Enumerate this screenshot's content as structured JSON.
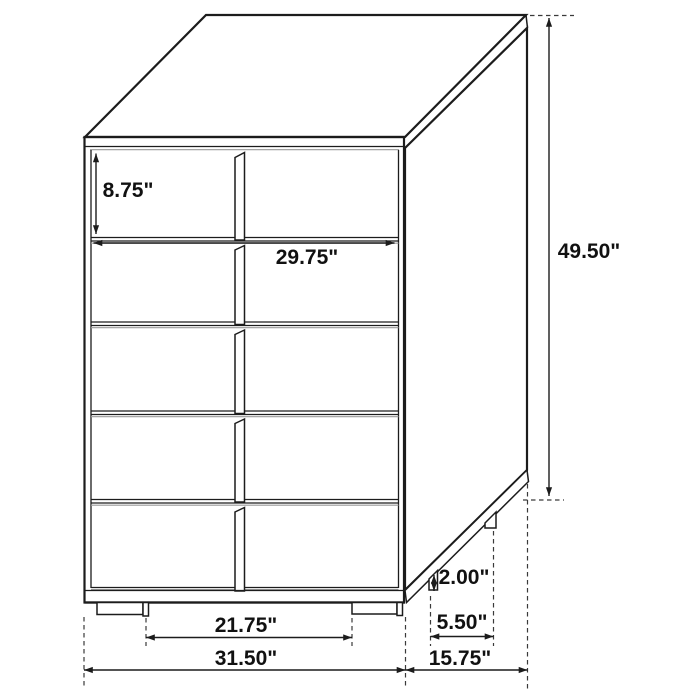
{
  "page": {
    "background": "#ffffff"
  },
  "drawing": {
    "type": "furniture-dimension-diagram",
    "object": "5-drawer chest (3D isometric line drawing)",
    "drawer_rows": 5,
    "drawer_columns": 2,
    "line_color": "#1c1c1c",
    "shadow_color": "#9a9a9a",
    "text_color": "#111111"
  },
  "dimensions": {
    "top_drawer_height": "8.75\"",
    "drawer_width": "29.75\"",
    "overall_height": "49.50\"",
    "foot_height": "2.00\"",
    "side_foot_spacing": "5.50\"",
    "front_foot_spacing": "21.75\"",
    "overall_width": "31.50\"",
    "overall_depth": "15.75\""
  }
}
